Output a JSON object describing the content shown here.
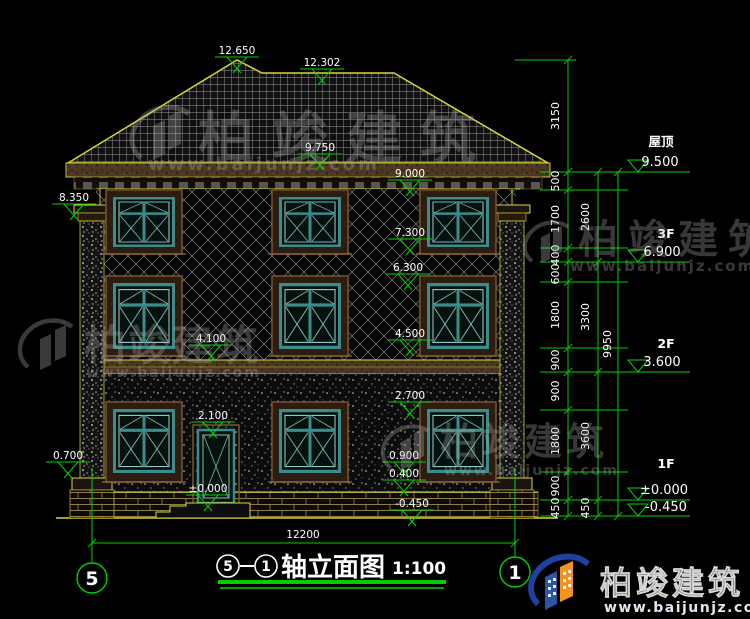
{
  "watermark": {
    "brand": "柏竣建筑",
    "site": "www.baijunjz.com"
  },
  "logo": {
    "brand": "柏竣建筑",
    "site": "www.baijunjz.com"
  },
  "title": {
    "axis_start": "5",
    "axis_end": "1",
    "name": "轴立面图",
    "scale": "1:100"
  },
  "axes": {
    "left": "5",
    "right": "1"
  },
  "dimensions": {
    "overall_width": "12200",
    "chain_inner": [
      "3150",
      "500",
      "1700",
      "400",
      "600",
      "1800",
      "900",
      "900",
      "1800",
      "900",
      "450"
    ],
    "chain_mid": [
      "2600",
      "3300",
      "3600",
      "450"
    ],
    "chain_outer": [
      "9950"
    ]
  },
  "levels": [
    {
      "name": "屋顶",
      "value": "9.500"
    },
    {
      "name": "3F",
      "value": "6.900"
    },
    {
      "name": "2F",
      "value": "3.600"
    },
    {
      "name": "1F",
      "value": "±0.000"
    },
    {
      "name": "",
      "value": "-0.450"
    }
  ],
  "markers": [
    {
      "label": "12.650"
    },
    {
      "label": "12.302"
    },
    {
      "label": "9.750"
    },
    {
      "label": "9.000"
    },
    {
      "label": "8.350"
    },
    {
      "label": "7.300"
    },
    {
      "label": "6.300"
    },
    {
      "label": "4.500"
    },
    {
      "label": "4.100"
    },
    {
      "label": "2.700"
    },
    {
      "label": "2.100"
    },
    {
      "label": "±0.000"
    },
    {
      "label": "0.900"
    },
    {
      "label": "0.400"
    },
    {
      "label": "-0.450"
    },
    {
      "label": "0.700"
    }
  ]
}
